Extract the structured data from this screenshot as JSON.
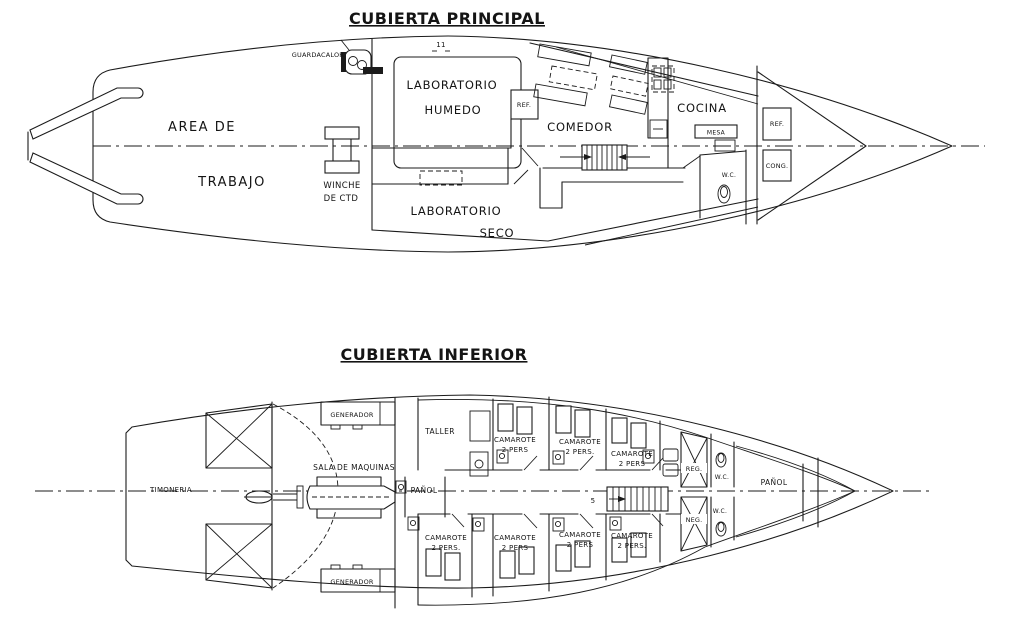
{
  "main_deck": {
    "title": "CUBIERTA  PRINCIPAL",
    "labels": {
      "guardacalor": "GUARDACALOR",
      "frame_mark": "11",
      "lab_humedo_line1": "LABORATORIO",
      "lab_humedo_line2": "HUMEDO",
      "ref_pantry": "REF.",
      "comedor": "COMEDOR",
      "cocina": "COCINA",
      "mesa": "MESA",
      "ref_bow": "REF.",
      "cong_bow": "CONG.",
      "wc": "W.C.",
      "winche_line1": "WINCHE",
      "winche_line2": "DE CTD",
      "area_trabajo_line1": "AREA  DE",
      "area_trabajo_line2": "TRABAJO",
      "lab_seco_line1": "LABORATORIO",
      "lab_seco_line2": "SECO"
    }
  },
  "lower_deck": {
    "title": "CUBIERTA  INFERIOR",
    "labels": {
      "timoneria": "TIMONERIA",
      "generador_top": "GENERADOR",
      "generador_bottom": "GENERADOR",
      "sala_de_maquinas": "SALA DE MAQUINAS",
      "taller": "TALLER",
      "panol_mid": "PAÑOL",
      "panol_bow": "PAÑOL",
      "reg": "REG.",
      "neg": "NEG.",
      "wc_top": "W.C.",
      "wc_bottom": "W.C.",
      "stair_mark": "5"
    },
    "cabins_top": [
      {
        "line1": "CAMAROTE",
        "line2": "2 PERS"
      },
      {
        "line1": "CAMAROTE",
        "line2": "2 PERS."
      },
      {
        "line1": "CAMAROTE",
        "line2": "2 PERS"
      }
    ],
    "cabins_bottom": [
      {
        "line1": "CAMAROTE",
        "line2": "2 PERS."
      },
      {
        "line1": "CAMAROTE",
        "line2": "2 PERS"
      },
      {
        "line1": "CAMAROTE",
        "line2": "2 PERS"
      },
      {
        "line1": "CAMAROTE",
        "line2": "2 PERS."
      }
    ]
  }
}
